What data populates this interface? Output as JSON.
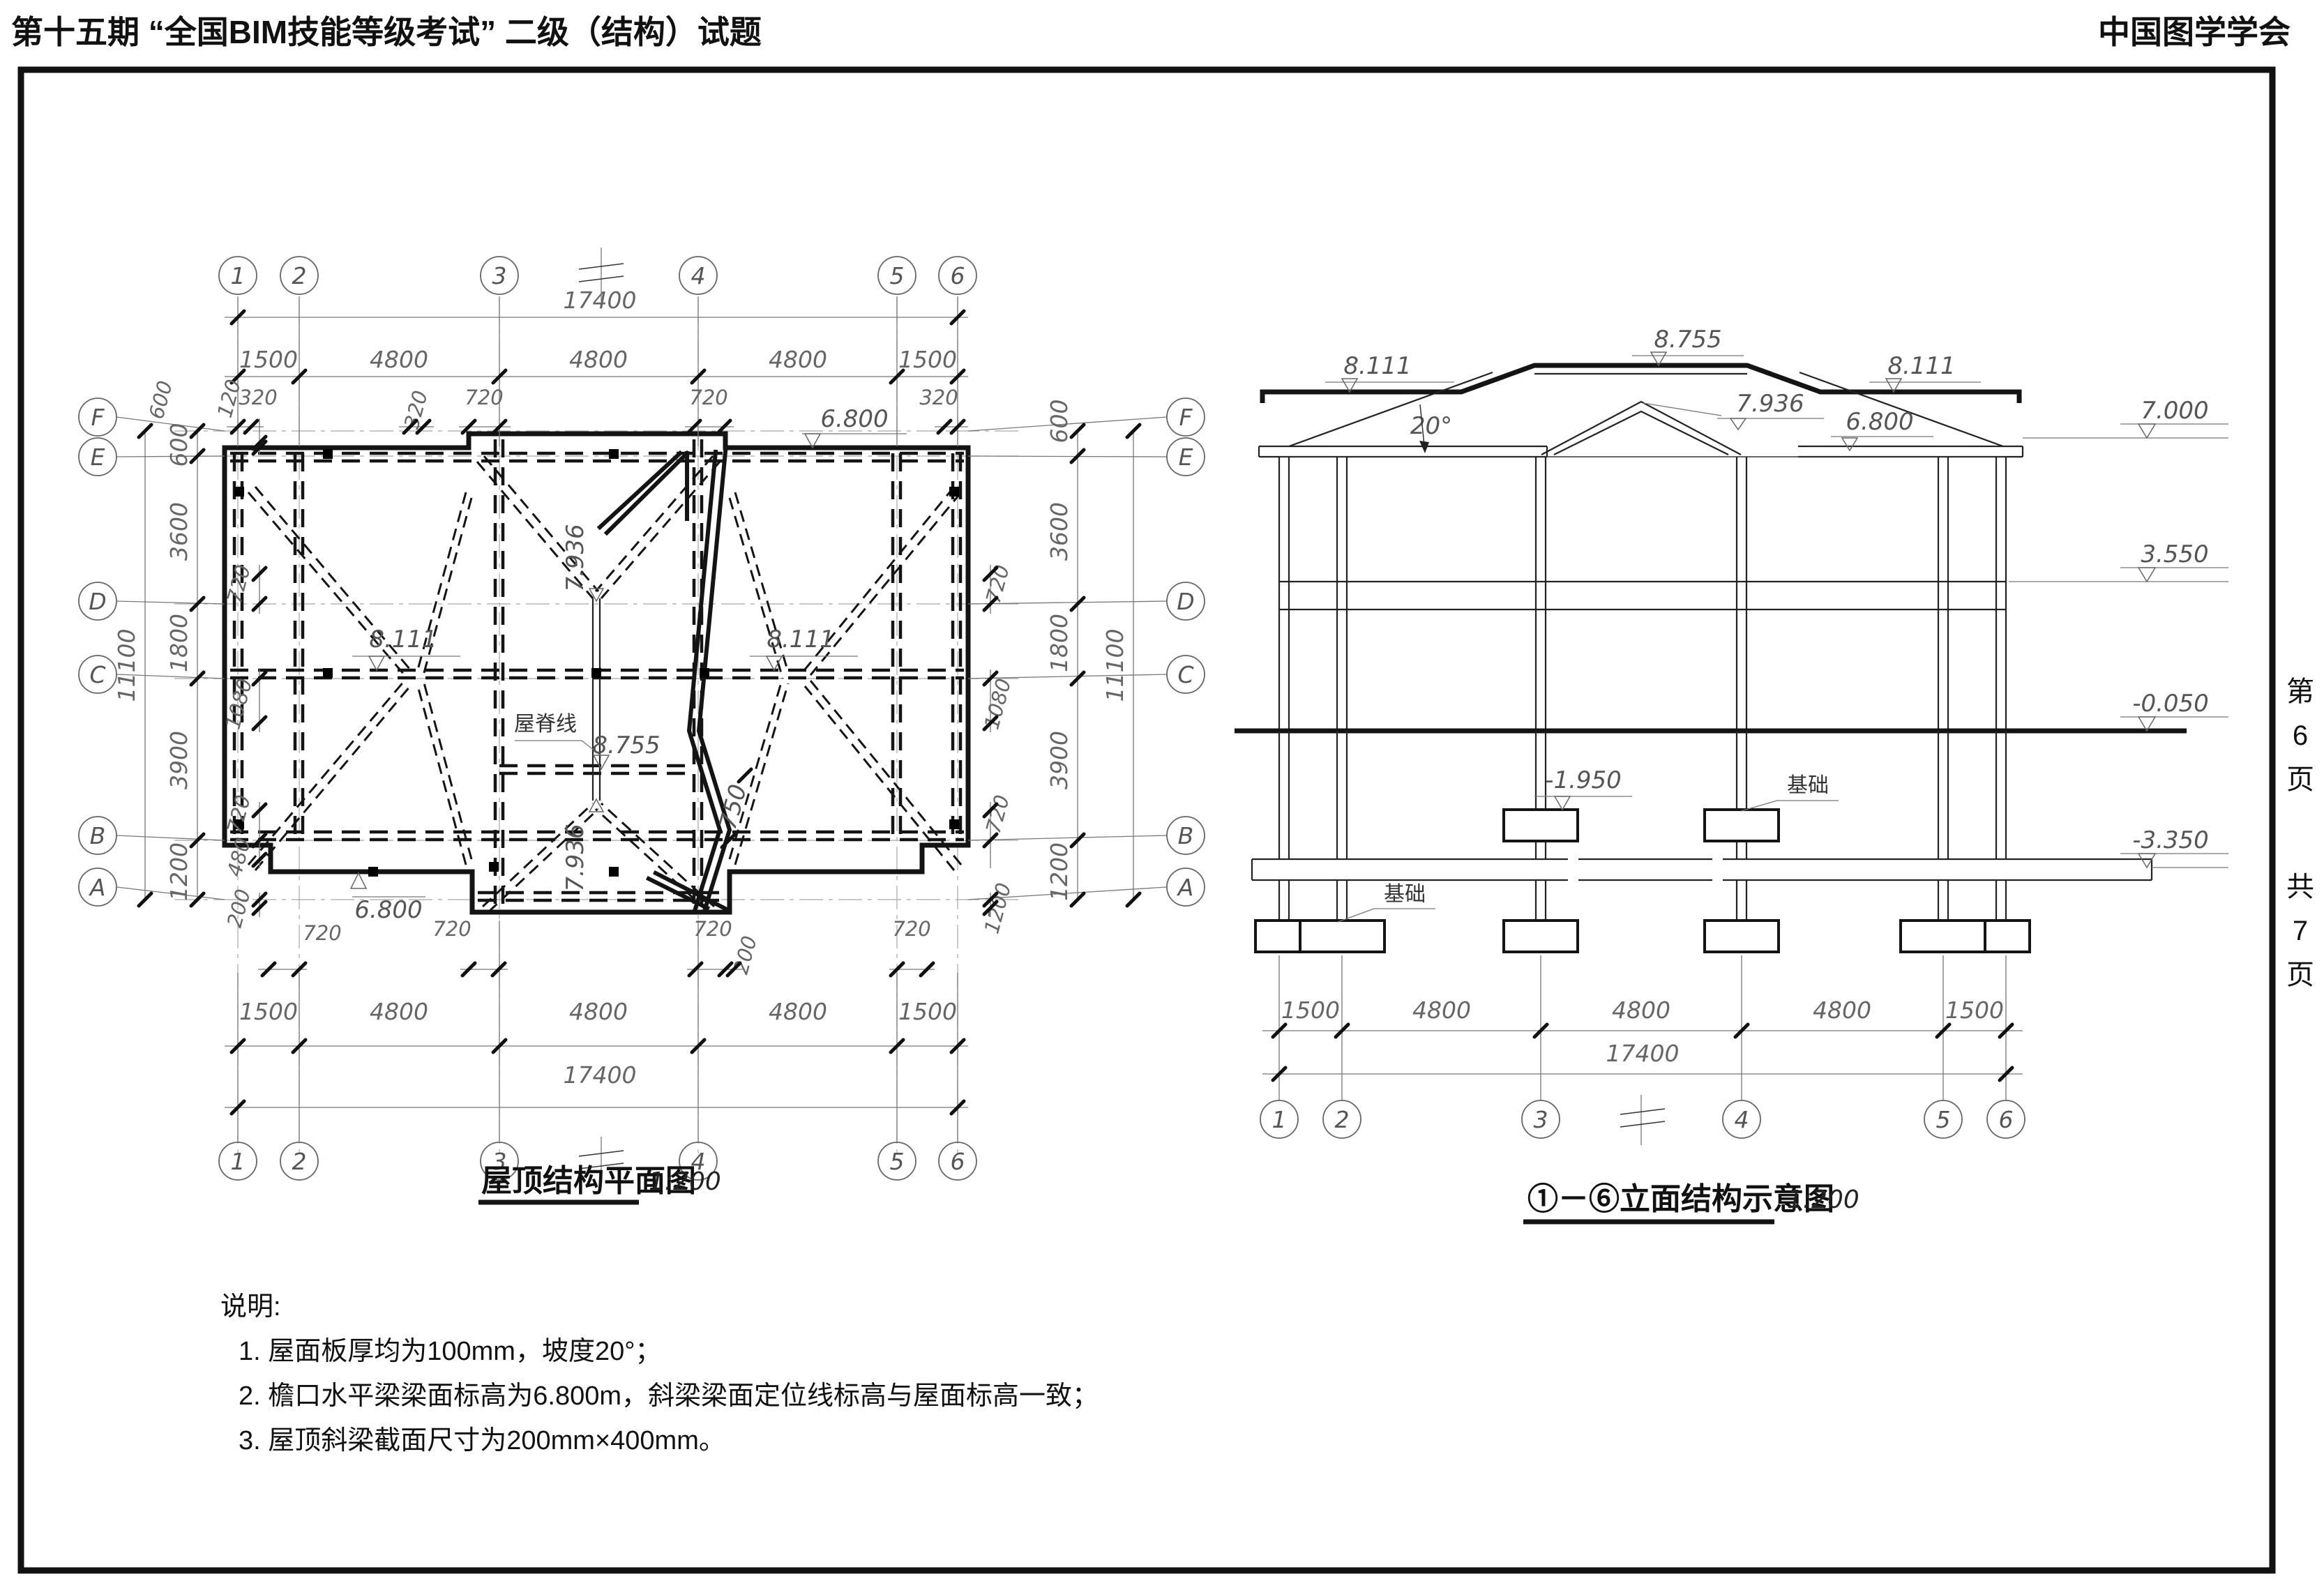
{
  "header": {
    "left": "第十五期 “全国BIM技能等级考试” 二级（结构）试题",
    "right": "中国图学学会"
  },
  "page": [
    "第",
    "6",
    "页",
    "共",
    "7",
    "页"
  ],
  "titles": {
    "plan": "屋顶结构平面图",
    "plan_scale": "1:200",
    "elev": "①－⑥立面结构示意图",
    "elev_scale": "1:200"
  },
  "notes": {
    "heading": "说明:",
    "items": [
      "1. 屋面板厚均为100mm，坡度20°；",
      "2. 檐口水平梁梁面标高为6.800m，斜梁梁面定位线标高与屋面标高一致；",
      "3. 屋顶斜梁截面尺寸为200mm×400mm。"
    ]
  },
  "grid": {
    "cols": [
      "1",
      "2",
      "3",
      "4",
      "5",
      "6"
    ],
    "rows": [
      "F",
      "E",
      "D",
      "C",
      "B",
      "A"
    ]
  },
  "dims": {
    "d17400": "17400",
    "d1500": "1500",
    "d4800": "4800",
    "d320": "320",
    "d720": "720",
    "d600": "600",
    "d3600": "3600",
    "d1800": "1800",
    "d3900": "3900",
    "d1200": "1200",
    "d11100": "11100",
    "d120": "120",
    "d1080": "1080",
    "d480": "480",
    "d200": "200",
    "d750": "750"
  },
  "levels": {
    "l8755": "8.755",
    "l8111": "8.111",
    "l7936": "7.936",
    "l7000": "7.000",
    "l6800": "6.800",
    "l3550": "3.550",
    "lm0050": "-0.050",
    "lm1950": "-1.950",
    "lm3350": "-3.350",
    "angle20": "20°"
  },
  "labels": {
    "ridge_line": "屋脊线",
    "foundation": "基础"
  }
}
